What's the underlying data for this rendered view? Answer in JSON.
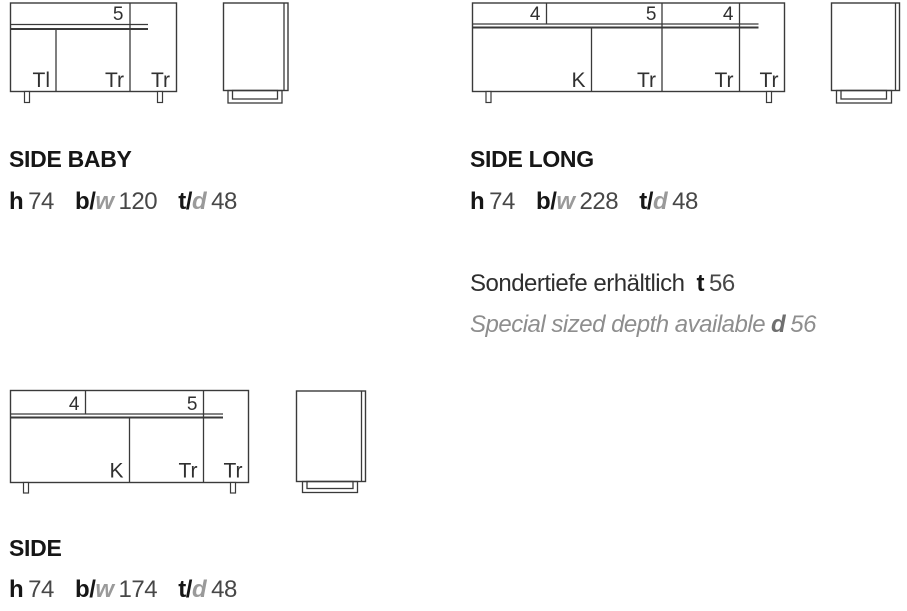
{
  "colors": {
    "line": "#3a3a3a",
    "title_text": "#161616",
    "value_text": "#474747",
    "muted_gray": "#8e8e8e"
  },
  "products": [
    {
      "name": "SIDE BABY",
      "front": {
        "top_labels": [
          "5"
        ],
        "bottom_labels": [
          "Tl",
          "Tr",
          "Tr"
        ]
      },
      "dims": {
        "h_key": "h",
        "h": "74",
        "b_key": "b/",
        "w_key": "w",
        "bw": "120",
        "t_key": "t/",
        "d_key": "d",
        "td": "48"
      }
    },
    {
      "name": "SIDE LONG",
      "front": {
        "top_labels": [
          "4",
          "5",
          "4"
        ],
        "bottom_labels": [
          "K",
          "Tr",
          "Tr",
          "Tr"
        ]
      },
      "dims": {
        "h_key": "h",
        "h": "74",
        "b_key": "b/",
        "w_key": "w",
        "bw": "228",
        "t_key": "t/",
        "d_key": "d",
        "td": "48"
      }
    },
    {
      "name": "SIDE",
      "front": {
        "top_labels": [
          "4",
          "5"
        ],
        "bottom_labels": [
          "K",
          "Tr",
          "Tr"
        ]
      },
      "dims": {
        "h_key": "h",
        "h": "74",
        "b_key": "b/",
        "w_key": "w",
        "bw": "174",
        "t_key": "t/",
        "d_key": "d",
        "td": "48"
      }
    }
  ],
  "note": {
    "de_text": "Sondertiefe erhältlich",
    "de_key": "t",
    "de_value": "56",
    "en_text": "Special sized depth available",
    "en_key": "d",
    "en_value": "56"
  }
}
